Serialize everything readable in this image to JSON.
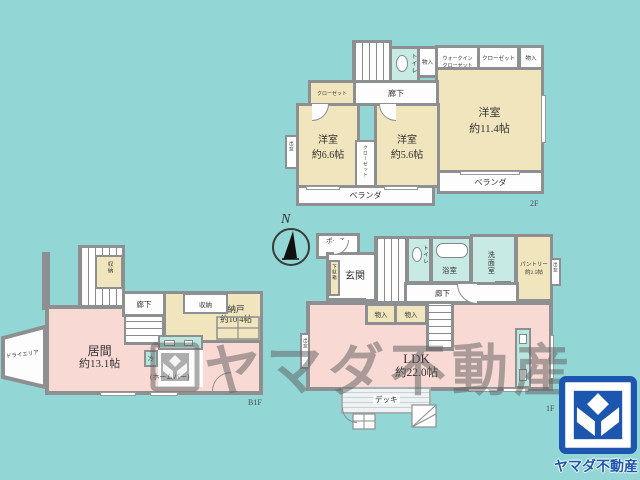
{
  "palette": {
    "background": "#92d7d6",
    "room_beige": "#f0e5bc",
    "room_pink": "#f9d9d3",
    "room_aqua": "#c7eae4",
    "wall_gray": "#8d8f90",
    "logo_blue": "#1c56ae",
    "watermark_gray": "#5f5f5f"
  },
  "compass": {
    "label": "N"
  },
  "watermark": {
    "text": "ヤマダ不動産"
  },
  "brand": {
    "name": "ヤマダ不動産"
  },
  "floor2": {
    "floor_label": "2F",
    "bedroom_small": {
      "name": "洋室",
      "size": "約6.6帖"
    },
    "bedroom_mid": {
      "name": "洋室",
      "size": "約5.6帖"
    },
    "bedroom_large": {
      "name": "洋室",
      "size": "約11.4帖"
    },
    "walkin_closet": {
      "line1": "ウォークイン",
      "line2": "クローゼット",
      "line3": "約1.3帖"
    },
    "closet_left": "クローゼット",
    "closet_center": "クローゼット",
    "closet_top": "クローゼット",
    "storage_top_left": "物入",
    "storage_top_right": "物入",
    "toilet": "トイレ",
    "hallway": "廊下",
    "bay_window": "出窓",
    "veranda_left": "ベランダ",
    "veranda_right": "ベランダ"
  },
  "basement": {
    "floor_label": "B1F",
    "living": {
      "name": "居間",
      "size": "約13.1帖"
    },
    "storage_room": {
      "name": "納戸",
      "size": "約10.4帖"
    },
    "closet_top": "収納",
    "closet_mid": "収納",
    "hallway": "廊下",
    "fridge": "冷",
    "home_bar": "(ホームバー)",
    "dry_area": "ドライエリア"
  },
  "floor1": {
    "floor_label": "1F",
    "ldk": {
      "name": "LDK",
      "size": "約22.0帖"
    },
    "porch": "ポーチ",
    "entrance": "玄関",
    "shoe_cabinet": "下駄箱",
    "hall": "ホール",
    "toilet": "トイレ",
    "bathroom": "浴室",
    "washroom": "洗面室",
    "washer": "洗",
    "pantry": {
      "line1": "パントリー",
      "line2": "約2.5帖"
    },
    "bay_window_right": "出窓",
    "bay_window_left": "出窓",
    "hallway": "廊下",
    "storage_a": "物入",
    "storage_b": "物入",
    "deck": "デッキ"
  }
}
